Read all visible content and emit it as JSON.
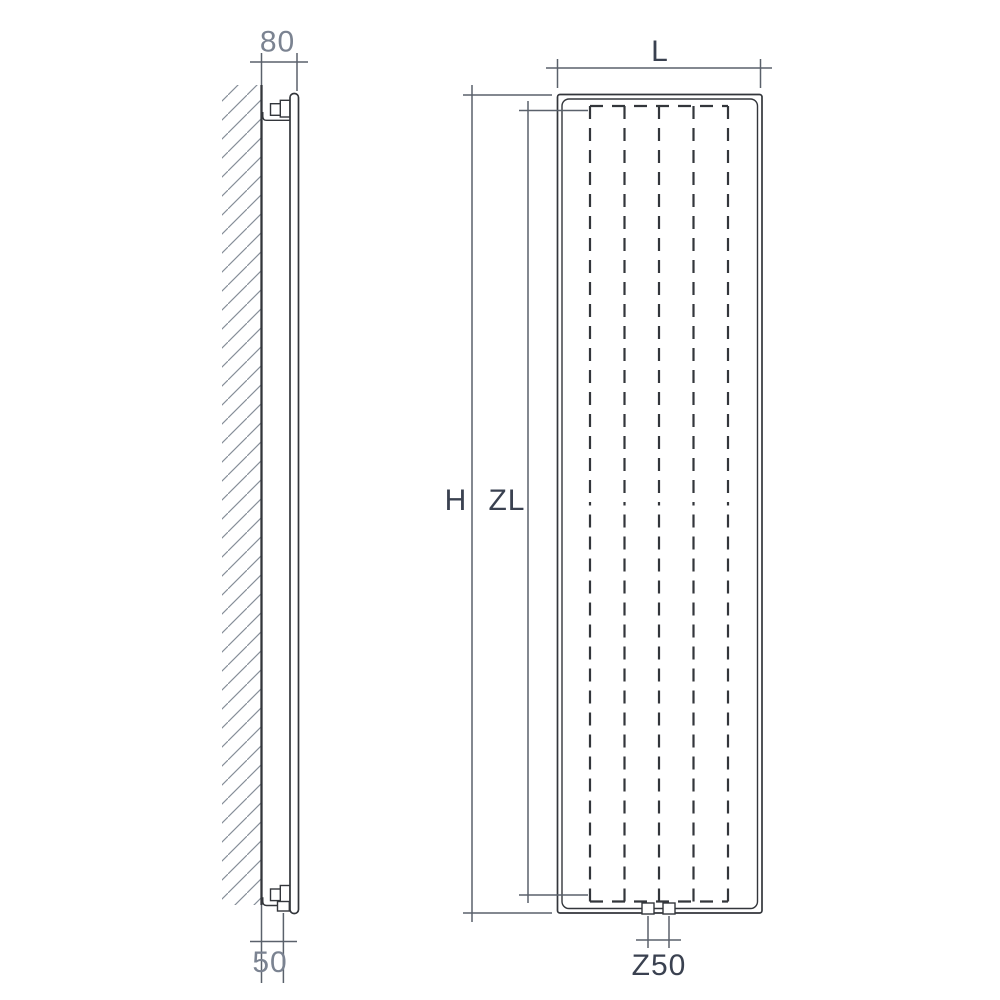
{
  "colors": {
    "background": "#ffffff",
    "object_line": "#33363b",
    "dimension_line": "#5a616b",
    "hatch": "#858d97",
    "label_dark": "#3a4150",
    "label_gray": "#7b8391"
  },
  "side_view": {
    "depth_dimension": "80",
    "wall_clearance_dimension": "50"
  },
  "front_view": {
    "width_dimension": "L",
    "height_dimension": "H",
    "fin_height_dimension": "ZL",
    "connection_spacing_dimension": "Z50"
  }
}
